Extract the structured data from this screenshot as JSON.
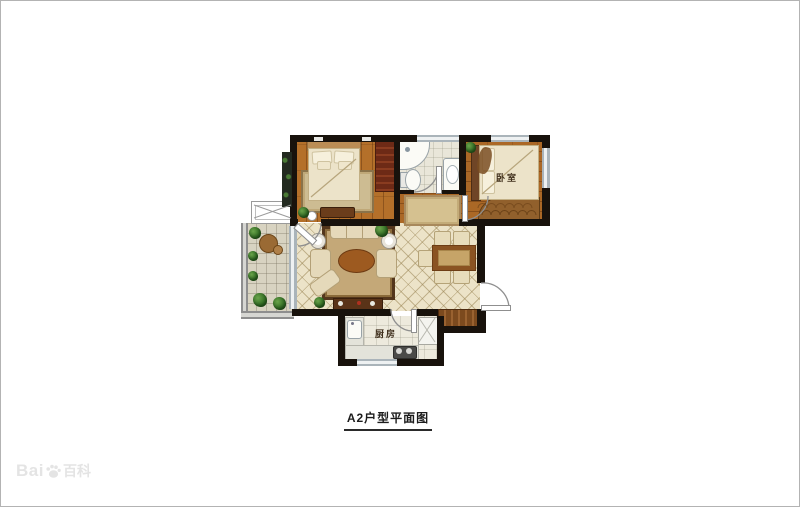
{
  "page": {
    "background": "#ffffff",
    "border_color": "#b3b3b3"
  },
  "floor_plan": {
    "labels": {
      "bedroom2": "卧室",
      "kitchen": "厨房"
    },
    "palette": {
      "wall": "#18120c",
      "wood_floor": "#b4702a",
      "tile_floor": "#ece3c8",
      "rug": "#c4a878",
      "wardrobe_red": "#6d2a16",
      "plant_green": "#3f7d2c",
      "window_gray": "#aab4ba",
      "rail_gray": "#8e8e8e"
    }
  },
  "caption": {
    "text": "A2户型平面图"
  },
  "watermark": {
    "latin": "Bai",
    "cjk": "百科"
  }
}
